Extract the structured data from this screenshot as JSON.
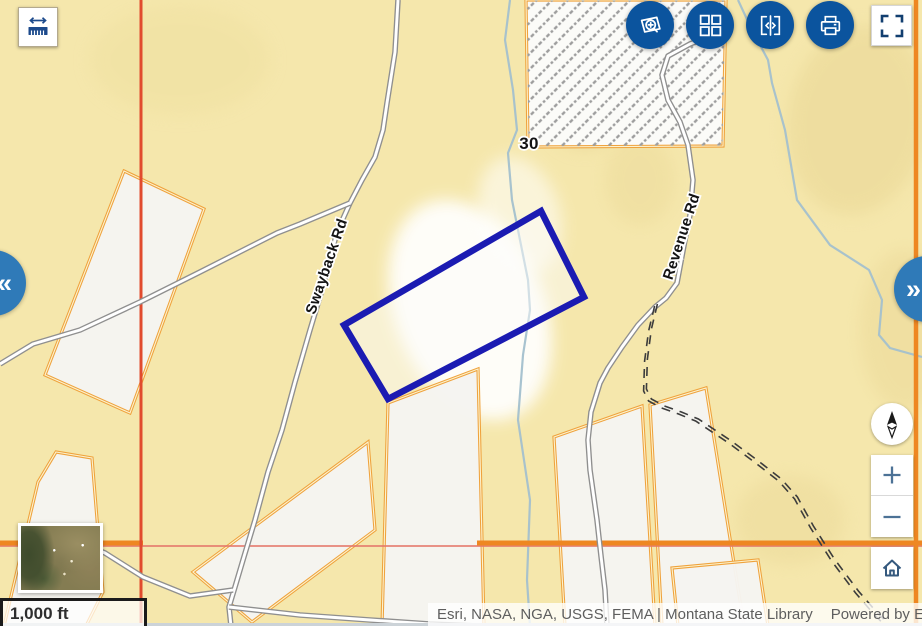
{
  "ui": {
    "measure_button": {
      "icon": "measure-distance-icon"
    },
    "toolbar": {
      "background": "#0b549e",
      "buttons": [
        {
          "name": "zoom-to-feature",
          "icon": "magnifier-parcel-icon"
        },
        {
          "name": "basemap-grid",
          "icon": "grid-icon"
        },
        {
          "name": "swipe-compare",
          "icon": "swipe-brackets-icon"
        },
        {
          "name": "print",
          "icon": "printer-icon"
        }
      ]
    },
    "fullscreen_button": {
      "icon": "fullscreen-corners-icon"
    },
    "panel_toggles": {
      "left_glyph": "«",
      "right_glyph": "»",
      "color": "#2f7ab8"
    },
    "nav_controls": {
      "zoom_in_glyph": "+",
      "zoom_out_glyph": "−",
      "home_icon": "home-icon",
      "compass_icon": "compass-needle-icon"
    },
    "overview_thumbnail": {
      "type": "aerial-imagery-basemap-toggle"
    },
    "scale_bar": {
      "label": "1,000 ft"
    },
    "attribution": {
      "sources": "Esri, NASA, NGA, USGS, FEMA | Montana State Library",
      "powered_by": "Powered by Esri"
    }
  },
  "map": {
    "colors": {
      "background": "#f5e7ac",
      "parcel_fill": "#f5f4f1",
      "parcel_outline": "#efa23c",
      "parcel_inner_line": "#fcf3cf",
      "selected_outline": "#1b1bb2",
      "road_casing": "#8f8f8f",
      "road_fill": "#ffffff",
      "dashed_road": "#3c3c3c",
      "stream": "#a3c0cd",
      "section_red": "#e14b2e",
      "section_pink": "#e5776b",
      "section_orange": "#ee8722",
      "hatch_line": "#9d9d9d"
    },
    "labels": [
      {
        "text": "Swayback Rd",
        "x": 331,
        "y": 268,
        "angle": -71,
        "size": 15
      },
      {
        "text": "Revenue Rd",
        "x": 686,
        "y": 238,
        "angle": -72,
        "size": 15
      },
      {
        "text": "30",
        "x": 529,
        "y": 149,
        "angle": 0,
        "size": 17
      }
    ],
    "features": {
      "terrain": [
        {
          "cx": 470,
          "cy": 310,
          "rx": 75,
          "ry": 115,
          "rot": -22,
          "fill": "#ffffff",
          "op": 0.92
        },
        {
          "cx": 520,
          "cy": 215,
          "rx": 40,
          "ry": 60,
          "rot": -18,
          "fill": "#ffffff",
          "op": 0.55
        },
        {
          "cx": 585,
          "cy": 95,
          "rx": 45,
          "ry": 55,
          "rot": 0,
          "fill": "#e6d391",
          "op": 0.5
        },
        {
          "cx": 858,
          "cy": 120,
          "rx": 70,
          "ry": 95,
          "rot": 10,
          "fill": "#e8d593",
          "op": 0.5
        },
        {
          "cx": 905,
          "cy": 330,
          "rx": 45,
          "ry": 80,
          "rot": 0,
          "fill": "#ead795",
          "op": 0.45
        },
        {
          "cx": 790,
          "cy": 520,
          "rx": 55,
          "ry": 45,
          "rot": 0,
          "fill": "#e9d694",
          "op": 0.4
        },
        {
          "cx": 180,
          "cy": 60,
          "rx": 90,
          "ry": 55,
          "rot": 0,
          "fill": "#efe0a0",
          "op": 0.5
        },
        {
          "cx": 640,
          "cy": 180,
          "rx": 35,
          "ry": 45,
          "rot": 0,
          "fill": "#e8d593",
          "op": 0.35
        }
      ],
      "streams": [
        {
          "d": "M510,0 L505,40 L513,90 L517,130 L508,153 L512,200 L520,240 L528,280 L530,310 L523,355 L518,420 L524,460 L530,500 L527,580 L530,626"
        },
        {
          "d": "M738,0 L752,30 L768,60 L772,83 L785,130 L797,200 L830,245 L869,270 L882,300 L879,335 L890,348 L922,357"
        }
      ],
      "parcels": [
        {
          "pts": [
            [
              124,
              171
            ],
            [
              204,
              209
            ],
            [
              130,
              413
            ],
            [
              45,
              375
            ]
          ]
        },
        {
          "pts": [
            [
              56,
              452
            ],
            [
              92,
              458
            ],
            [
              103,
              592
            ],
            [
              86,
              626
            ],
            [
              4,
              626
            ],
            [
              38,
              482
            ]
          ]
        },
        {
          "pts": [
            [
              193,
              572
            ],
            [
              368,
              442
            ],
            [
              375,
              530
            ],
            [
              252,
              622
            ]
          ]
        },
        {
          "pts": [
            [
              388,
              403
            ],
            [
              478,
              369
            ],
            [
              484,
              626
            ],
            [
              382,
              626
            ]
          ]
        },
        {
          "pts": [
            [
              554,
              437
            ],
            [
              642,
              406
            ],
            [
              655,
              626
            ],
            [
              565,
              626
            ]
          ]
        },
        {
          "pts": [
            [
              650,
              405
            ],
            [
              706,
              388
            ],
            [
              744,
              626
            ],
            [
              662,
              626
            ]
          ]
        },
        {
          "pts": [
            [
              672,
              568
            ],
            [
              758,
              560
            ],
            [
              768,
              626
            ],
            [
              678,
              626
            ]
          ]
        }
      ],
      "hatch_parcel": {
        "pts": [
          [
            526,
            0
          ],
          [
            726,
            0
          ],
          [
            723,
            146
          ],
          [
            528,
            147
          ]
        ]
      },
      "section_lines": {
        "pink_horizontal_y": 546,
        "orange_horizontal_y": 543,
        "orange_horizontal_segments": [
          [
            0,
            143
          ],
          [
            477,
            922
          ]
        ],
        "red_vertical_x": 141,
        "orange_vertical_x": 916
      },
      "roads": [
        {
          "d": "M398,0 L395,52 L387,103 L383,130 L375,157 L362,180 L350,203 L337,232 L322,290 L310,330 L295,382 L282,430 L268,472 L255,520 L243,560 L235,587 L229,607 L231,626"
        },
        {
          "d": "M350,203 L300,224 L277,233 L200,272 L140,302 L80,330 L33,344 L0,364"
        },
        {
          "d": "M233,590 L190,596 L143,577 L105,553 L58,534"
        },
        {
          "d": "M229,607 L300,615 L370,620 L430,624 L478,626"
        },
        {
          "d": "M726,30 L690,44 L668,56 L662,75 L668,100 L680,122 L688,145 L693,180 L690,215 L685,240 L677,283 L666,298 L655,307 L638,325 L622,347 L608,368 L600,383 L591,412 L588,440 L590,470 L597,520 L601,556 L605,590 L607,626"
        }
      ],
      "dashed_roads": [
        {
          "d": "M656,305 L650,330 L646,360 L645,390 L650,400 L663,407 L680,413 L697,420 L730,442 L757,462 L780,480 L796,498 L812,527 L833,560 L857,592 L876,614 L888,626"
        }
      ],
      "selected_parcel": {
        "pts": [
          [
            541,
            211
          ],
          [
            584,
            297
          ],
          [
            388,
            399
          ],
          [
            344,
            325
          ]
        ]
      }
    }
  }
}
